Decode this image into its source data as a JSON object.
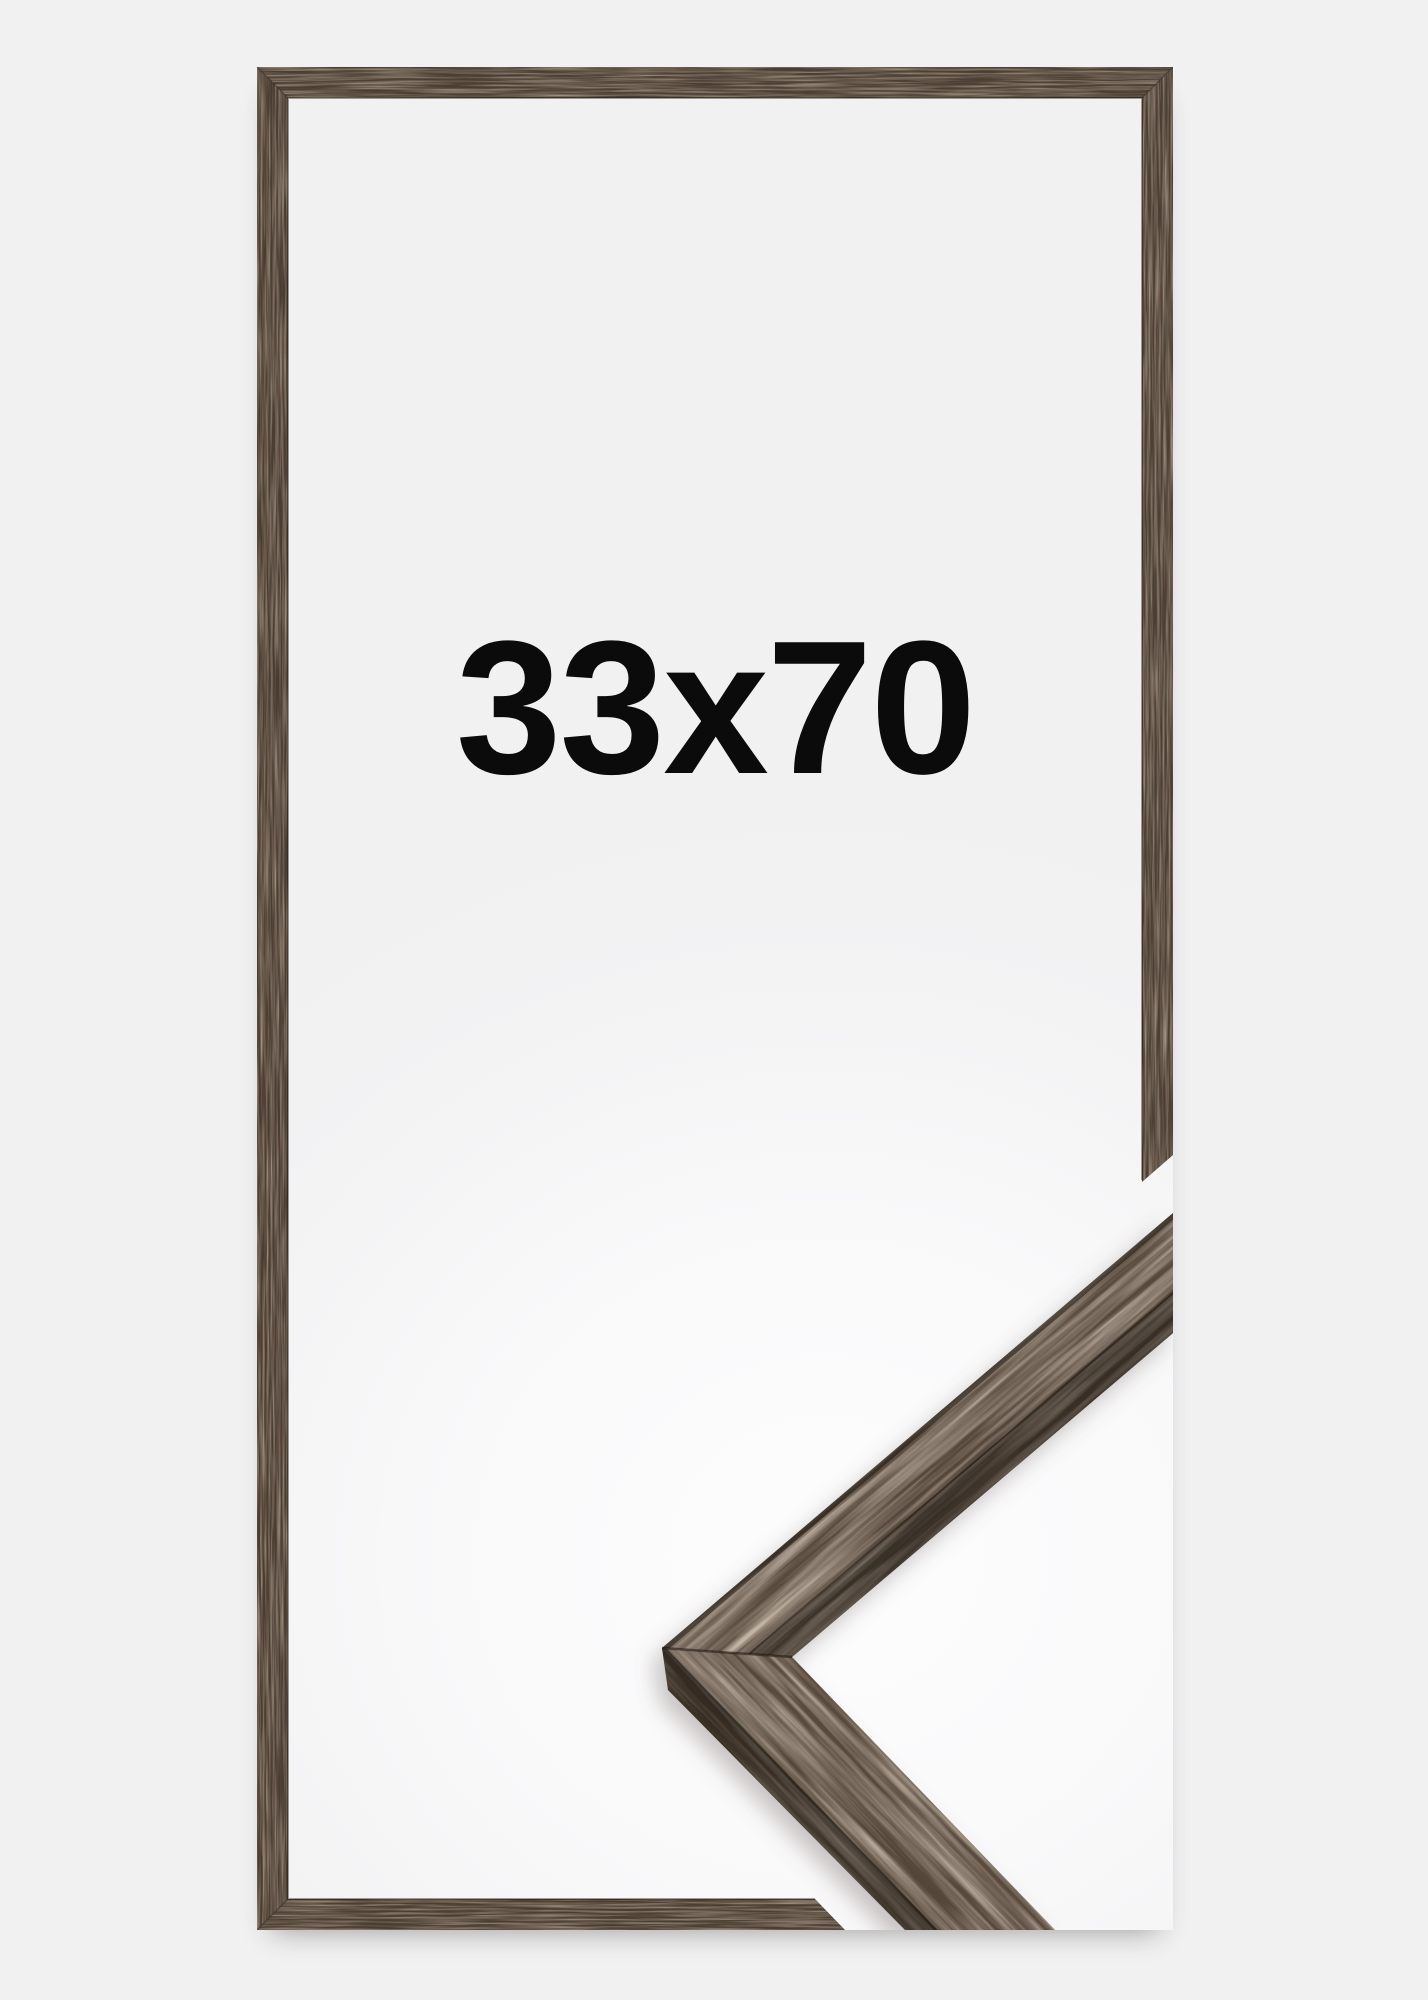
{
  "product_image": {
    "size_label": "33x70",
    "description": "Dark walnut wooden picture frame shown front-on with an enlarged 3D corner detail at the lower right"
  },
  "colors": {
    "page-bg": "#f1f1f2",
    "canvas-bg": "#fbfbfc",
    "wood-base": "#4a3e33",
    "wood-face-light": "#5e5042",
    "wood-face-dark": "#4b3f34",
    "wood-band-dark": "#31291f",
    "label-color": "#0b0b0b"
  }
}
